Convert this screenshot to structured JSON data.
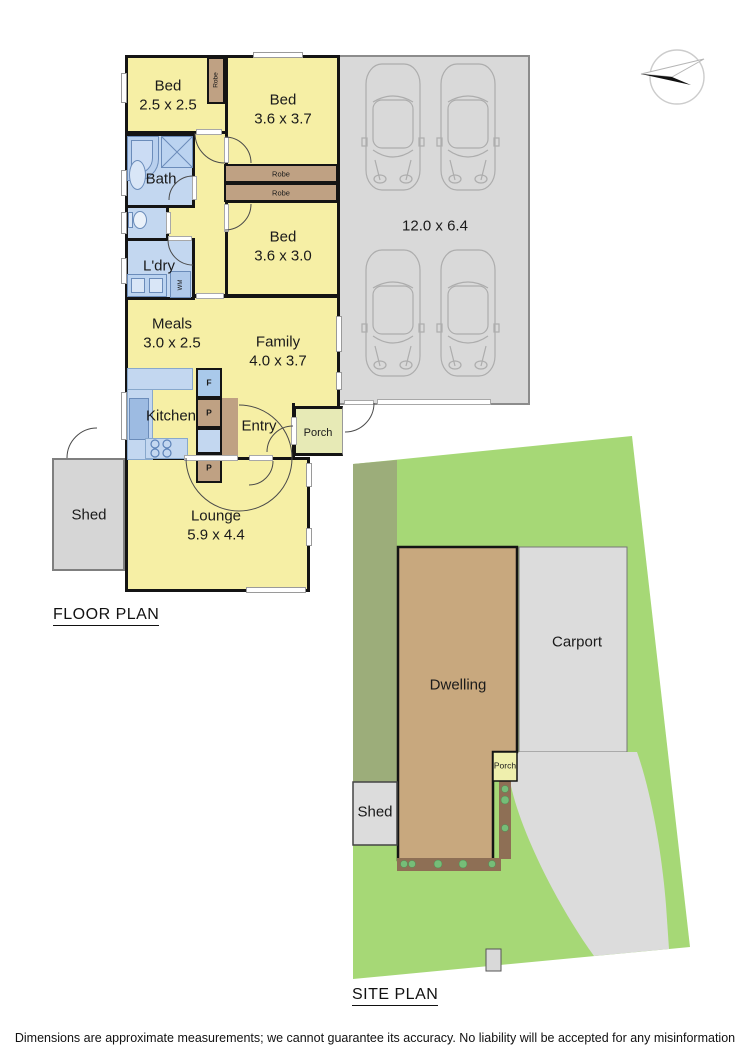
{
  "floor_plan": {
    "title": "FLOOR PLAN",
    "rooms": {
      "bed1": {
        "name": "Bed",
        "dims": "2.5 x 2.5"
      },
      "bed2": {
        "name": "Bed",
        "dims": "3.6 x 3.7"
      },
      "bed3": {
        "name": "Bed",
        "dims": "3.6 x 3.0"
      },
      "bath": {
        "name": "Bath"
      },
      "laundry": {
        "name": "L'dry"
      },
      "meals": {
        "name": "Meals",
        "dims": "3.0 x 2.5"
      },
      "family": {
        "name": "Family",
        "dims": "4.0 x 3.7"
      },
      "kitchen": {
        "name": "Kitchen"
      },
      "entry": {
        "name": "Entry"
      },
      "porch": {
        "name": "Porch"
      },
      "lounge": {
        "name": "Lounge",
        "dims": "5.9 x 4.4"
      },
      "shed": {
        "name": "Shed"
      },
      "garage": {
        "dims": "12.0 x 6.4"
      }
    },
    "fixtures": {
      "robe1": "Robe",
      "robe2": "Robe",
      "robe3": "Robe",
      "washing_machine": "WM",
      "fridge": "F",
      "pantry1": "P",
      "pantry2": "P"
    }
  },
  "site_plan": {
    "title": "SITE PLAN",
    "labels": {
      "dwelling": "Dwelling",
      "carport": "Carport",
      "shed": "Shed",
      "porch": "Porch"
    }
  },
  "footer": {
    "disclaimer": "Dimensions are approximate measurements; we cannot guarantee its accuracy. No liability will be accepted for any misinformation"
  },
  "colors": {
    "room_yellow": "#F6EFA5",
    "wet_area_blue": "#C3D7F0",
    "robe_brown": "#BFA183",
    "garage_grey": "#D9D9D9",
    "porch_green": "#E7EAB6",
    "lot_green": "#A6D876",
    "verge_olive": "#9CAD7A",
    "dwelling_tan": "#C8A87E",
    "paving_grey": "#DCDCDC",
    "garden_brown": "#8E6F55"
  }
}
